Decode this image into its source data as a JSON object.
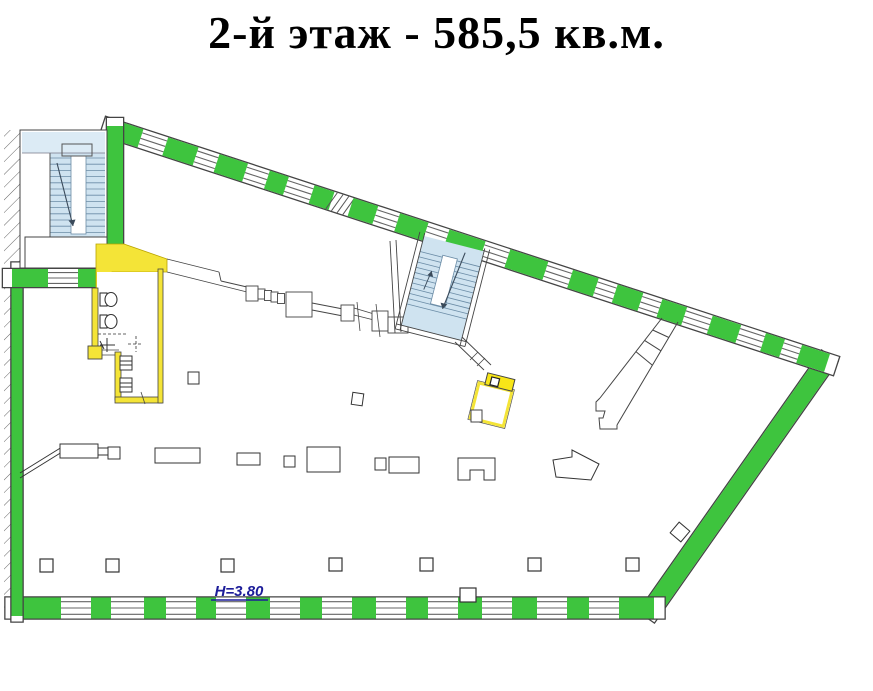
{
  "title": "2-й этаж - 585,5 кв.м.",
  "floor_plan": {
    "height_label": "H=3.80",
    "colors": {
      "wall_green": "#3ec43e",
      "stair_blue": "#cfe3f0",
      "stair_blue_light": "#dcebf5",
      "service_yellow": "#f4e437",
      "service_yellow_bright": "#f8e618",
      "label_blue": "#1c1c99",
      "line": "#444444",
      "window_line": "#666666",
      "tread_line": "#6b8ca6"
    }
  }
}
